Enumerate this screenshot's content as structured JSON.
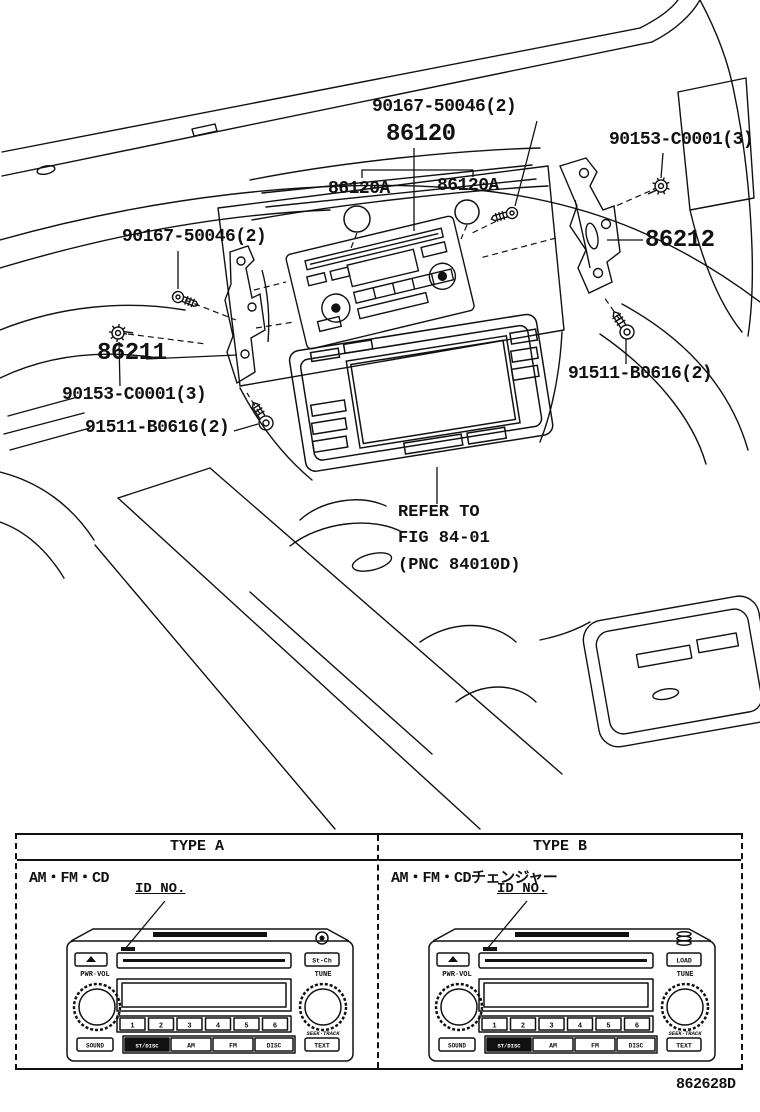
{
  "diagram": {
    "labels": {
      "screw_top": "90167-50046(2)",
      "receiver": "86120",
      "knob_left": "86120A",
      "knob_right": "86120A",
      "clip_right": "90153-C0001(3)",
      "bracket_right": "86212",
      "screw_left": "90167-50046(2)",
      "bracket_left": "86211",
      "clip_left": "90153-C0001(3)",
      "bolt_left": "91511-B0616(2)",
      "bolt_right": "91511-B0616(2)",
      "refer_line1": "REFER TO",
      "refer_line2": "FIG 84-01",
      "refer_line3": "(PNC 84010D)"
    },
    "footer_code": "862628D"
  },
  "icons": {
    "eject_icon": "▲",
    "cd_icon": "disc",
    "cd_changer_icon": "disc-stack"
  },
  "table": {
    "type_a": {
      "header": "TYPE A",
      "system": "AM・FM・CD",
      "id_label": "ID NO.",
      "radio": {
        "volume_knob": "PWR·VOL",
        "tune_knob": "TUNE",
        "side_button": "St-Ch",
        "presets": [
          "1",
          "2",
          "3",
          "4",
          "5",
          "6"
        ],
        "sound_button": "SOUND",
        "mode_button": "ST/DISC",
        "am_button": "AM",
        "fm_button": "FM",
        "disc_button": "DISC",
        "text_button": "TEXT",
        "seek_label": "SEEK·TRACK"
      }
    },
    "type_b": {
      "header": "TYPE B",
      "system": "AM・FM・CDチェンジャー",
      "id_label": "ID NO.",
      "radio": {
        "volume_knob": "PWR·VOL",
        "tune_knob": "TUNE",
        "side_button": "LOAD",
        "presets": [
          "1",
          "2",
          "3",
          "4",
          "5",
          "6"
        ],
        "sound_button": "SOUND",
        "mode_button": "ST/DISC",
        "am_button": "AM",
        "fm_button": "FM",
        "disc_button": "DISC",
        "text_button": "TEXT",
        "seek_label": "SEEK·TRACK"
      }
    }
  }
}
